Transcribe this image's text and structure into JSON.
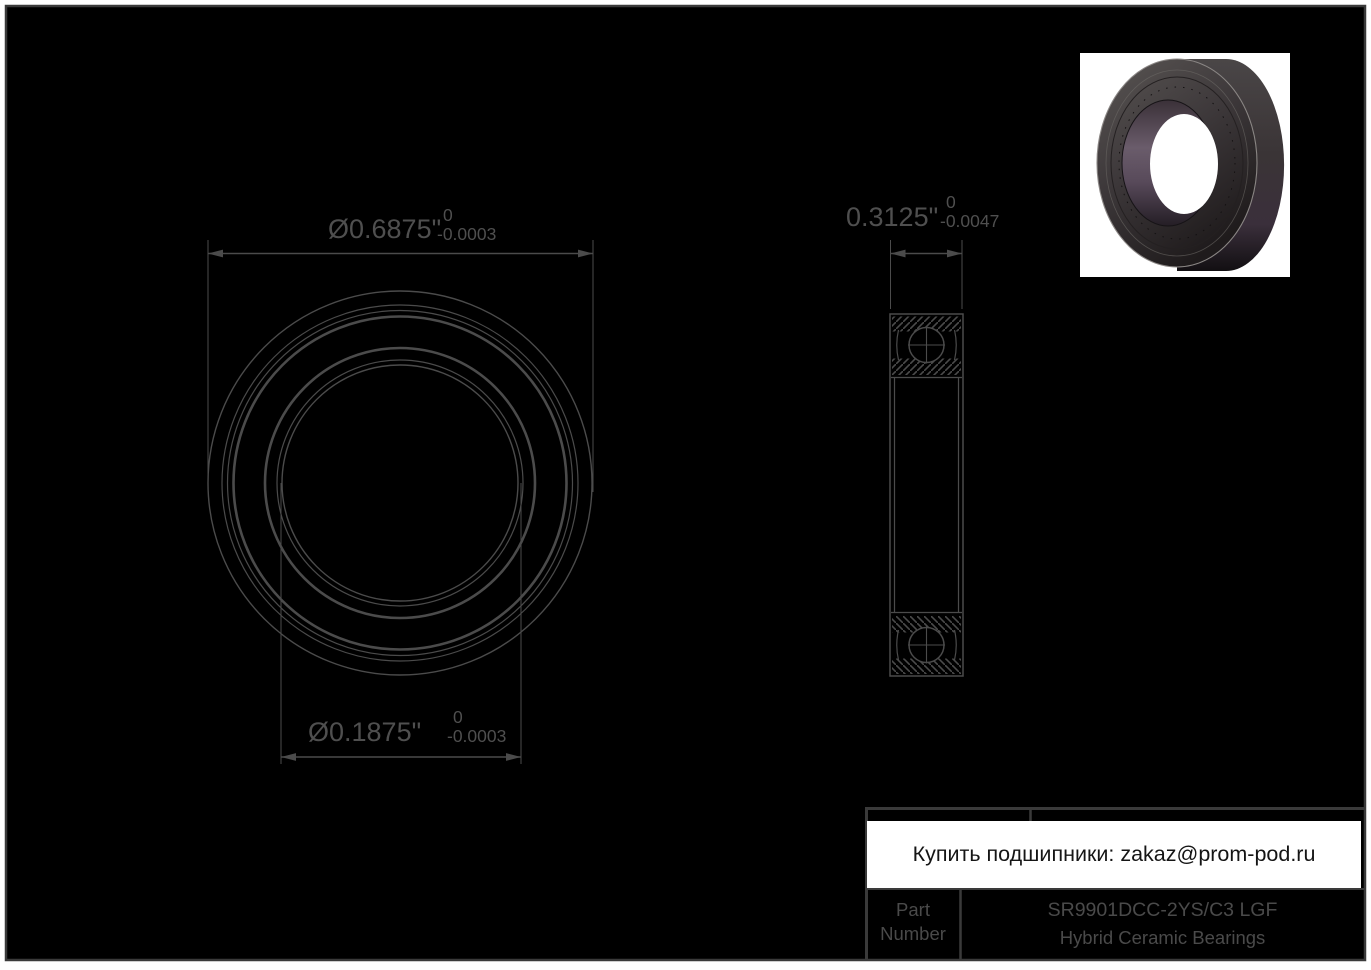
{
  "colors": {
    "canvas_bg": "#000000",
    "frame_border": "#3a3a3a",
    "line": "#4b4b4b",
    "dimension_text": "#4f4f4f",
    "banner_bg": "#ffffff",
    "banner_text": "#151515",
    "bore_accent": "#6a5c6b"
  },
  "dimensions": {
    "outer_diameter": {
      "value": "Ø0.6875\"",
      "tolerance_upper": "0",
      "tolerance_lower": "-0.0003"
    },
    "bore_diameter": {
      "value": "Ø0.1875\"",
      "tolerance_upper": "0",
      "tolerance_lower": "-0.0003"
    },
    "width": {
      "value": "0.3125\"",
      "tolerance_upper": "0",
      "tolerance_lower": "-0.0047"
    }
  },
  "banner": {
    "text": "Купить подшипники: zakaz@prom-pod.ru"
  },
  "title_block": {
    "row_label": "Part Number",
    "part_number": "SR9901DCC-2YS/C3 LGF",
    "series": "Hybrid Ceramic Bearings"
  },
  "images": {
    "render": "bearing-3d-render"
  }
}
